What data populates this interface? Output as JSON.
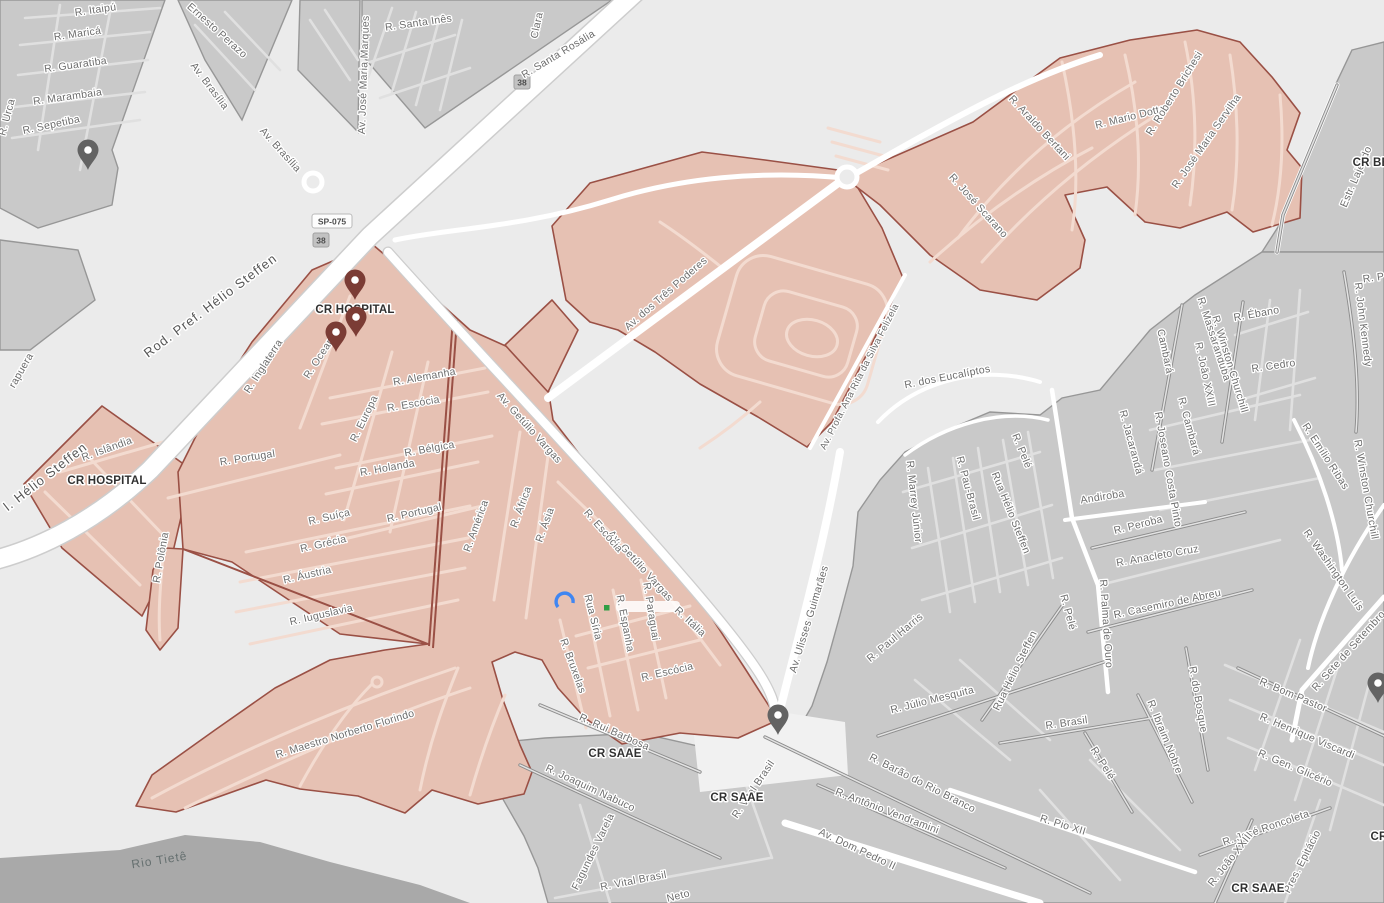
{
  "map": {
    "river_label": "Rio Tietê",
    "route_shields": {
      "sp075": "SP-075",
      "route_38": "38"
    },
    "place_labels": [
      "CR HOSPITAL",
      "CR SAAE",
      "CR BE",
      "CR"
    ],
    "street_labels": [
      "R. Itaipú",
      "R. Maricá",
      "R. Guaratiba",
      "R. Marambaia",
      "R. Sepetiba",
      "R. Urca",
      "Ernesto Perazo",
      "Av. Brasília",
      "Av. José Maria Marques",
      "R. Santa Inês",
      "Clara",
      "R. Santa Rosália",
      "Rod. Pref. Hélio Steffen",
      "l. Hélio Steffen",
      "rapuera",
      "R. Araldo Bertani",
      "R. Mario Dotta",
      "R. Roberto Brichesi",
      "R. José Maria Servilha",
      "R. José Scarano",
      "Estr. Lajeado",
      "Av. dos Três Poderes",
      "Av. Profa. Ana Rita da Silva Felizela",
      "R. dos Eucalíptos",
      "R. Marrey Júnior",
      "R. Pelé",
      "R. Pau-Brasil",
      "Rua Hélio Steffen",
      "Andiroba",
      "R. Peroba",
      "R. Anacleto Cruz",
      "R. Jacarandá",
      "R. Joseano Costa Pinto",
      "R. Cambará",
      "Cambará",
      "R. João XXIII",
      "R. Massaranduba",
      "R. Ébano",
      "R. Cedro",
      "R. Winston Churchill",
      "R. John Kennedy",
      "R. Emílio Ribas",
      "R. Washington Luís",
      "R. P",
      "R. Casemiro de Abreu",
      "R. do Bosque",
      "R. Ibraim Nobre",
      "R. Palma de Ouro",
      "R. Paul Harris",
      "R. Júlio Mesquita",
      "R. Brasil",
      "R. Barão do Rio Branco",
      "R. Antônio Vendramini",
      "Av. Dom Pedro II",
      "R. Pio XII",
      "R. Bom Pastor",
      "R. Henrique Viscardi",
      "R. Gen. Glicério",
      "R. José Roncoleta",
      "Pres. Epitácio",
      "R. Sete de Setembro",
      "R. Joaquim Nabuco",
      "Fagundes Varela",
      "R. Vital Brasil",
      "Neto",
      "R. Rui Barbosa",
      "Av. Ulisses Guimarães",
      "Av. Getúlio Vargas",
      "R. Itália",
      "R. Escócia",
      "Rua Síria",
      "R. Espanha",
      "R. Paraguai",
      "R. Bruxelas",
      "R. Maestro Norberto Florindo",
      "R. Iuguslavia",
      "R. Áustria",
      "R. Grécia",
      "R. Suíça",
      "R. Portugal",
      "R. América",
      "R. Polônia",
      "R. Holanda",
      "R. Bélgica",
      "R. Alemanha",
      "R. Europa",
      "R. África",
      "R. Ásia",
      "R. Inglaterra",
      "R. Oceania",
      "R. Islândia"
    ],
    "colors": {
      "base": "#ebebeb",
      "block_gray": "#c9c9c9",
      "block_street": "#e0e0e0",
      "highlight_fill": "#e6c1b3",
      "highlight_street": "#f3dbd0",
      "highlight_border": "#9a5045",
      "road_white": "#ffffff",
      "river": "#a9a9a9",
      "label_gray": "#6d6d6d",
      "pin_red": "#7b3c35",
      "pin_gray": "#636363"
    }
  }
}
